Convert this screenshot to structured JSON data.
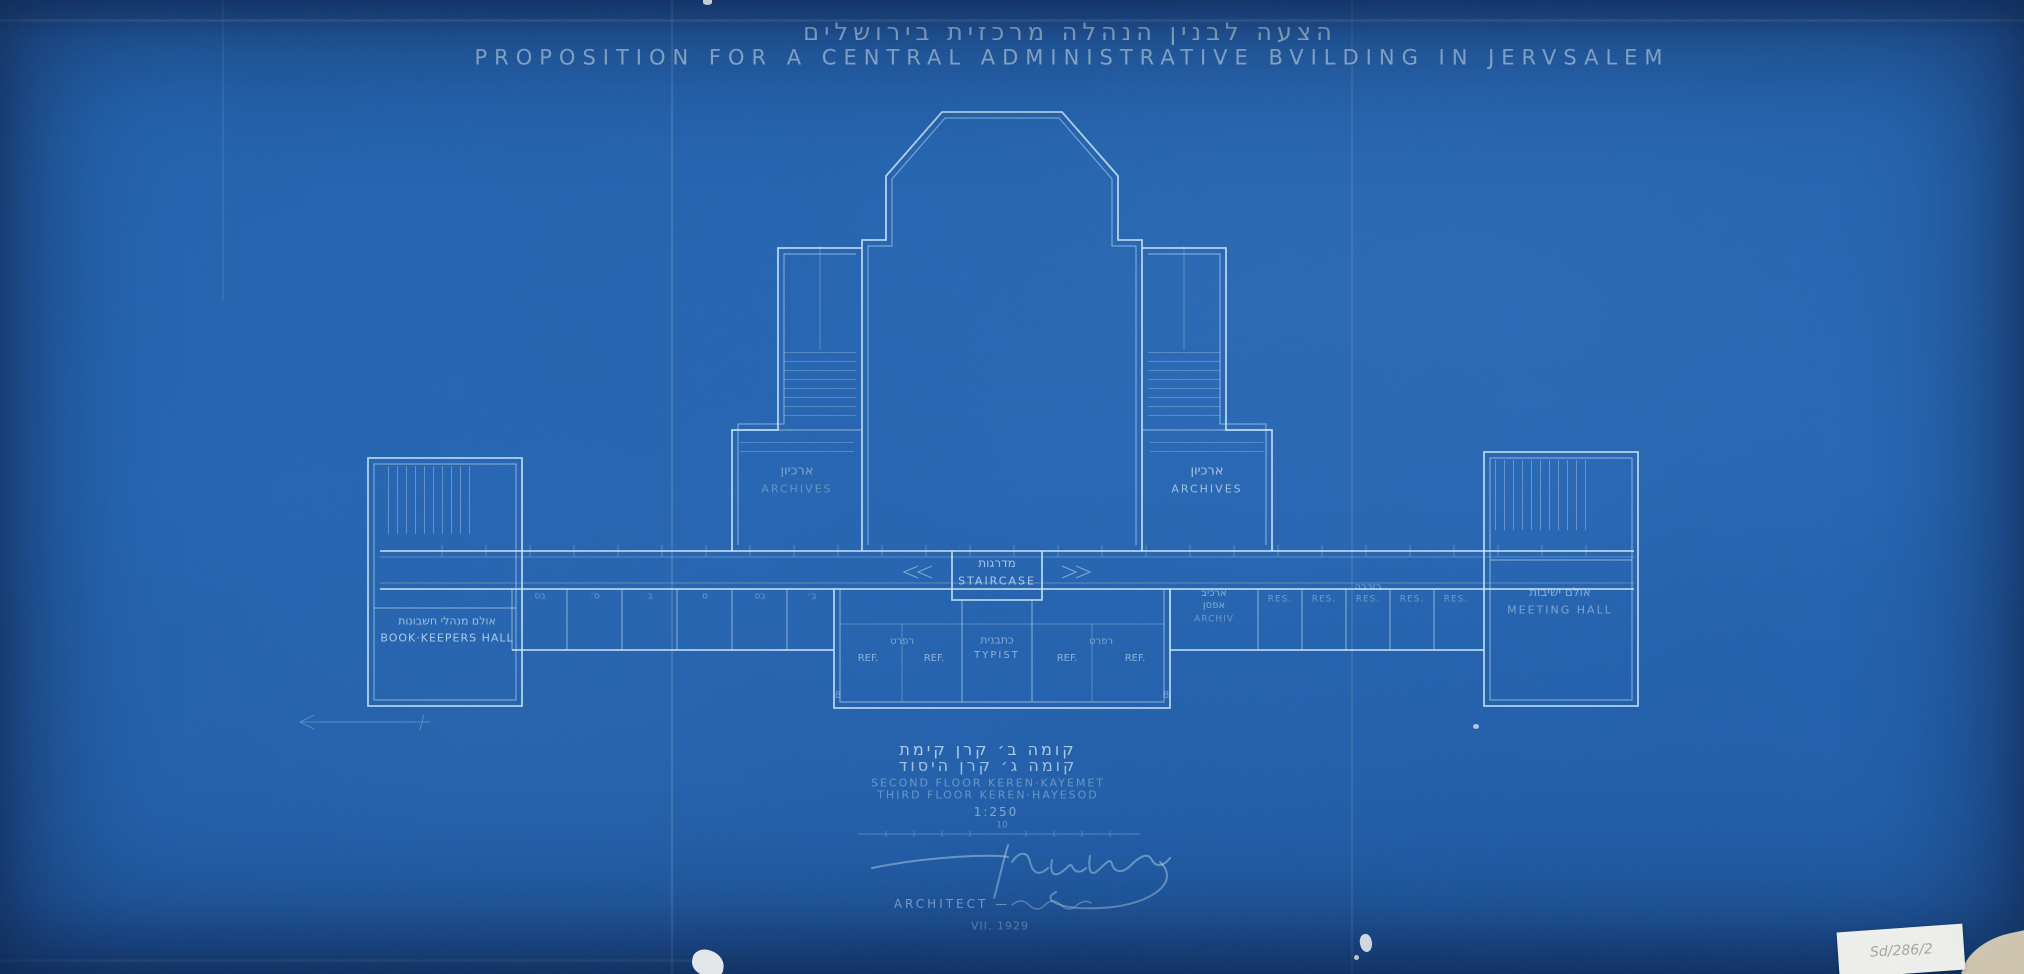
{
  "title": {
    "hebrew": "הצעה לבנין הנהלה מרכזית בירושלים",
    "english": "PROPOSITION FOR A CENTRAL ADMINISTRATIVE BVILDING IN JERVSALEM"
  },
  "plan": {
    "archives_left": {
      "he": "ארכיון",
      "en": "ARCHIVES"
    },
    "archives_right": {
      "he": "ארכיון",
      "en": "ARCHIVES"
    },
    "staircase": {
      "he": "מדרגות",
      "en": "STAIRCASE"
    },
    "book_keepers_hall": {
      "he": "אולם מנהלי חשבונות",
      "en": "BOOK·KEEPERS HALL"
    },
    "meeting_hall": {
      "he": "אולם ישיבות",
      "en": "MEETING HALL"
    },
    "typist": {
      "he": "כתבנית",
      "en": "TYPIST"
    },
    "ref_rooms": {
      "he_left": "רפרט",
      "he_right": "רפרט",
      "labels": [
        "REF.",
        "REF.",
        "REF.",
        "REF."
      ]
    },
    "reserve_rooms": {
      "he": "רזרבה",
      "labels": [
        "RES.",
        "RES.",
        "RES.",
        "RES.",
        "RES."
      ]
    },
    "archive_cell": {
      "he1": "ארכיב",
      "he2": "אפסן",
      "en": "ARCHIV"
    },
    "left_wing_cells": [
      "בס",
      "ס׳",
      "ב",
      "ס",
      "בס",
      "ב׳"
    ],
    "corner_mark_left": "8",
    "corner_mark_right": "8"
  },
  "legend": {
    "hebrew_line1": "קומה ב׳ קרן קימת",
    "hebrew_line2": "קומה ג׳ קרן היסוד",
    "english_line1": "SECOND FLOOR KEREN·KAYEMET",
    "english_line2": "THIRD FLOOR KEREN·HAYESOD",
    "scale": "1:250",
    "scale_bar_label": "10"
  },
  "signature": {
    "name": "Kornberg",
    "role_label": "ARCHITECT —",
    "date": "VII. 1929"
  },
  "sticker": {
    "text": "Sd/286/2"
  },
  "colors": {
    "paper": "#2161ae",
    "line_bright": "#cfeaf8",
    "line_faint": "#9cc8e8"
  }
}
